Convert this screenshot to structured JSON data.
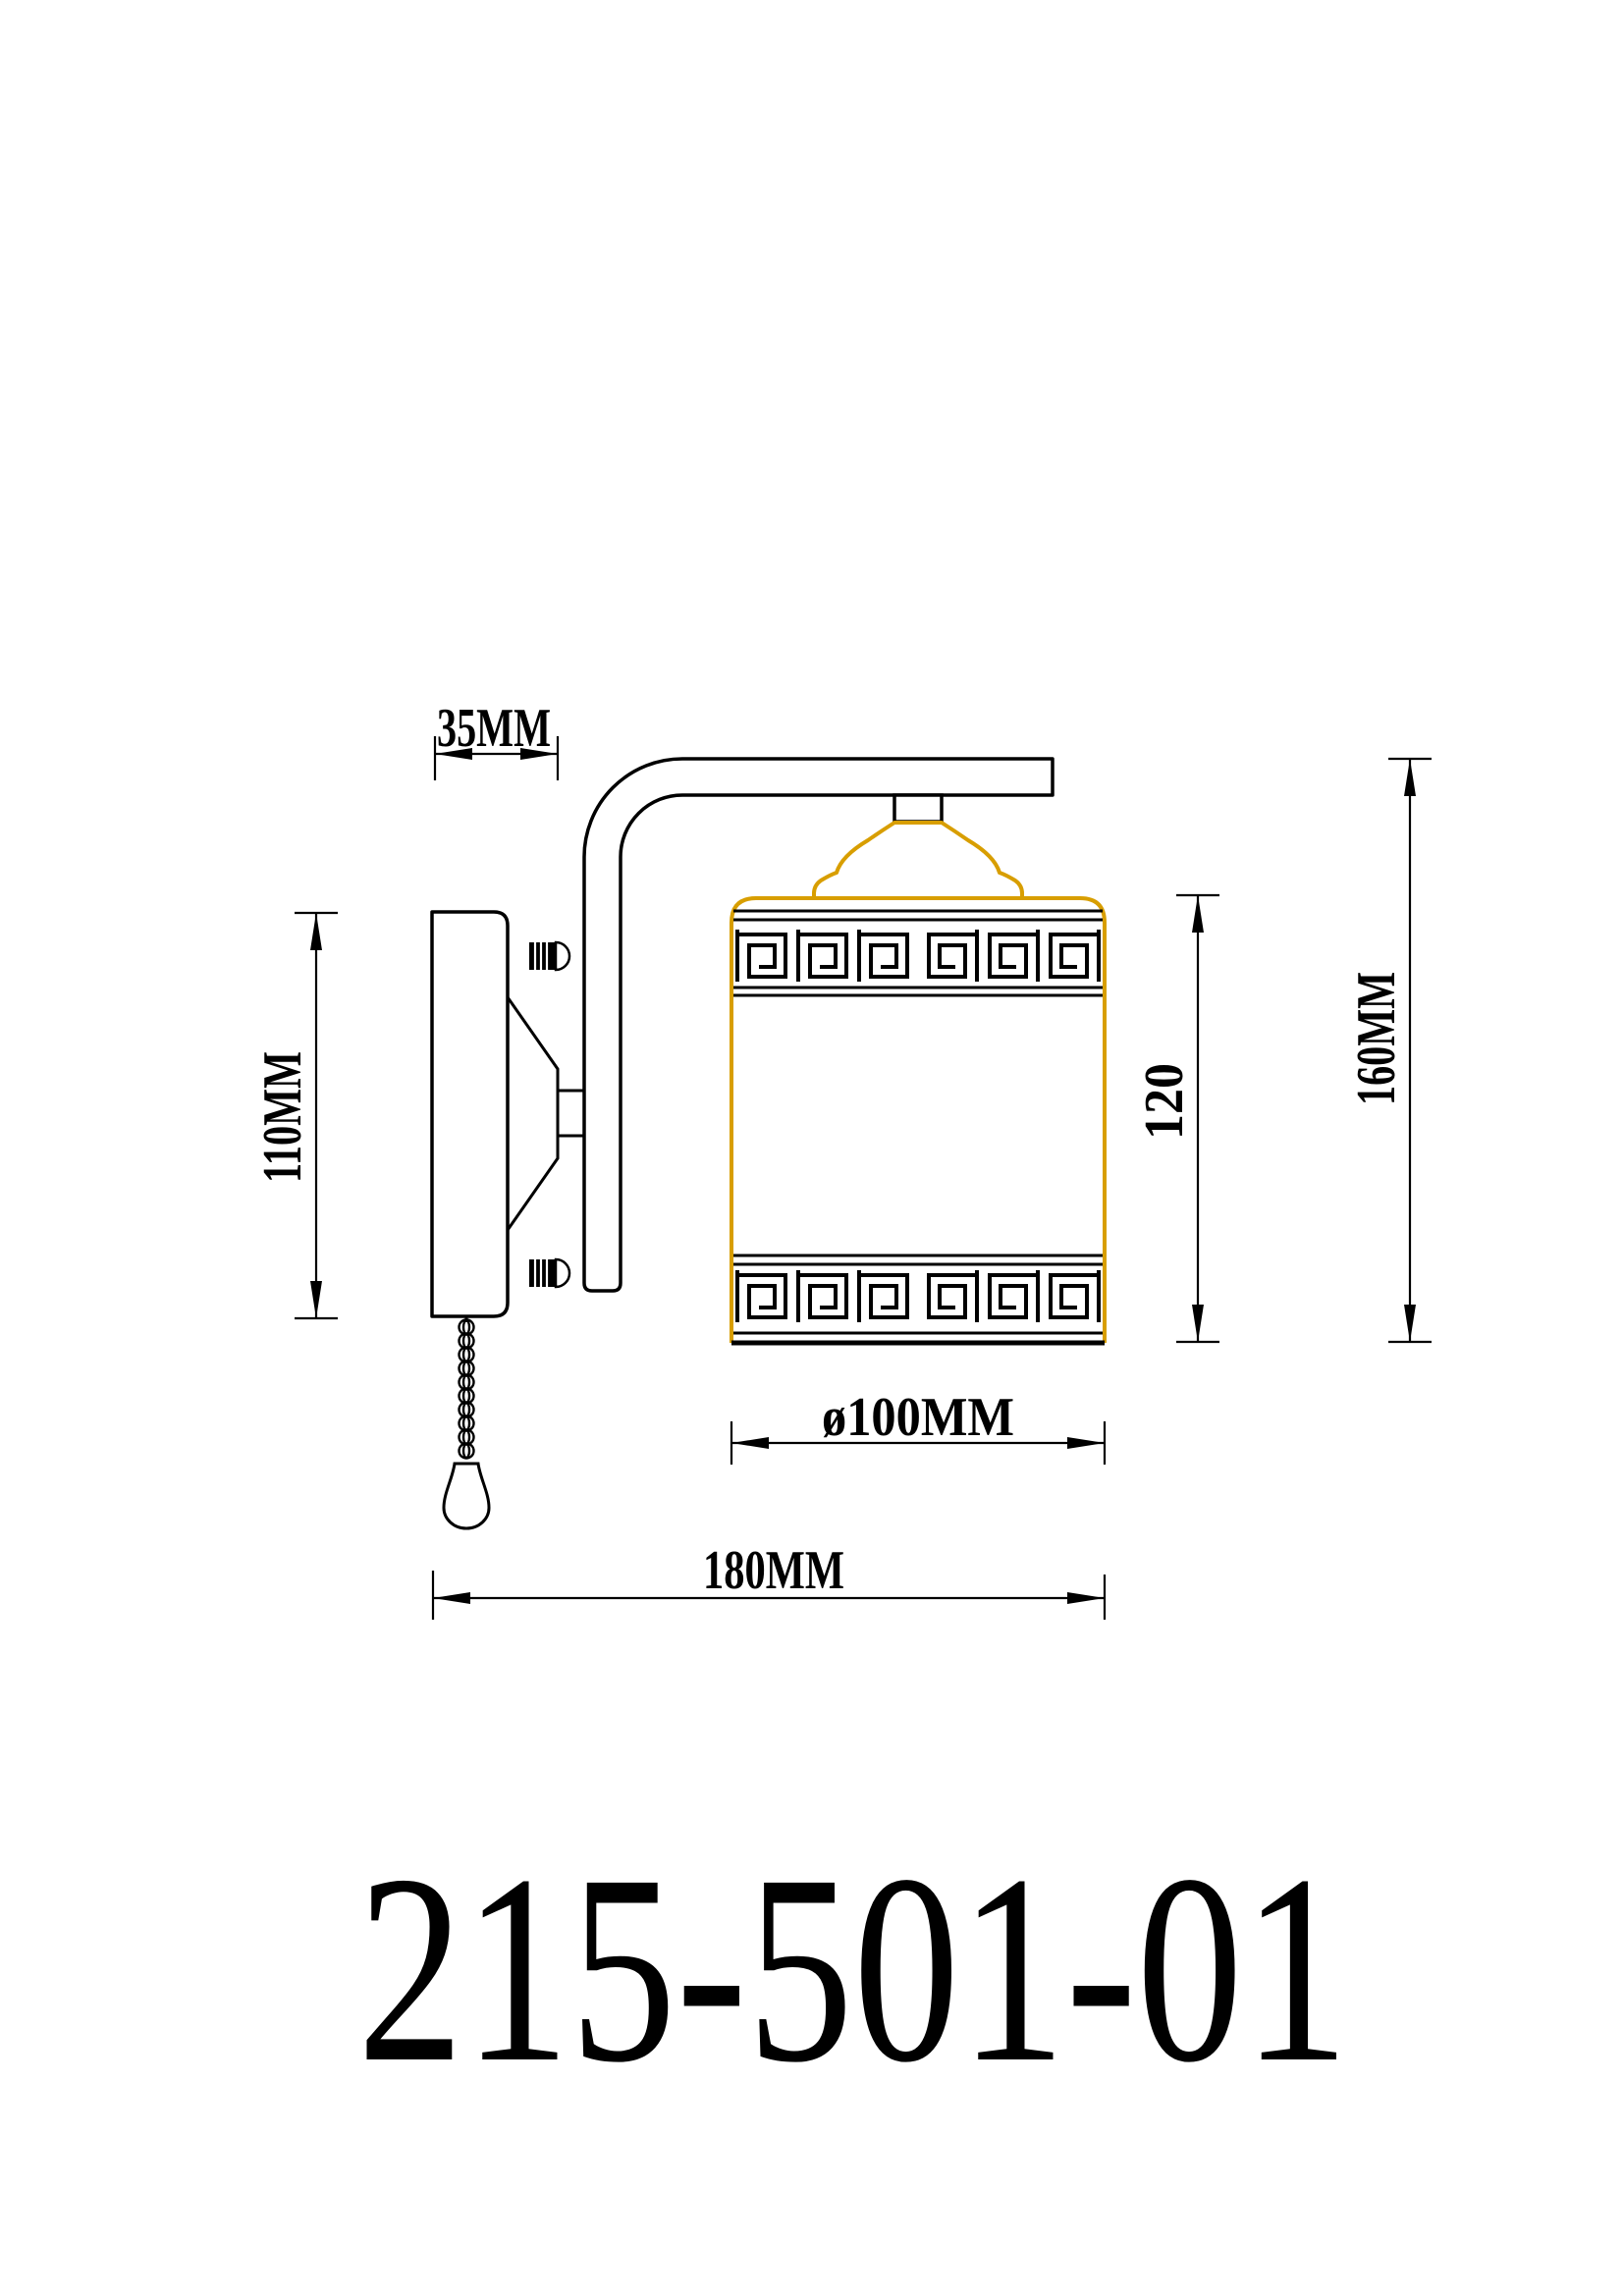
{
  "drawing": {
    "kind": "wall-lamp technical drawing, side elevation",
    "background": "#FFFFFF",
    "line_color": "#000000",
    "accent_gold": "#D89E00"
  },
  "dimensions": {
    "arm_offset": {
      "label": "35MM"
    },
    "backplate_height": {
      "label": "110MM"
    },
    "shade_height": {
      "label": "120"
    },
    "fixture_height": {
      "label": "160MM"
    },
    "shade_diameter": {
      "label": "ø100MM"
    },
    "fixture_width": {
      "label": "180MM"
    }
  },
  "product_code": "215-501-01"
}
